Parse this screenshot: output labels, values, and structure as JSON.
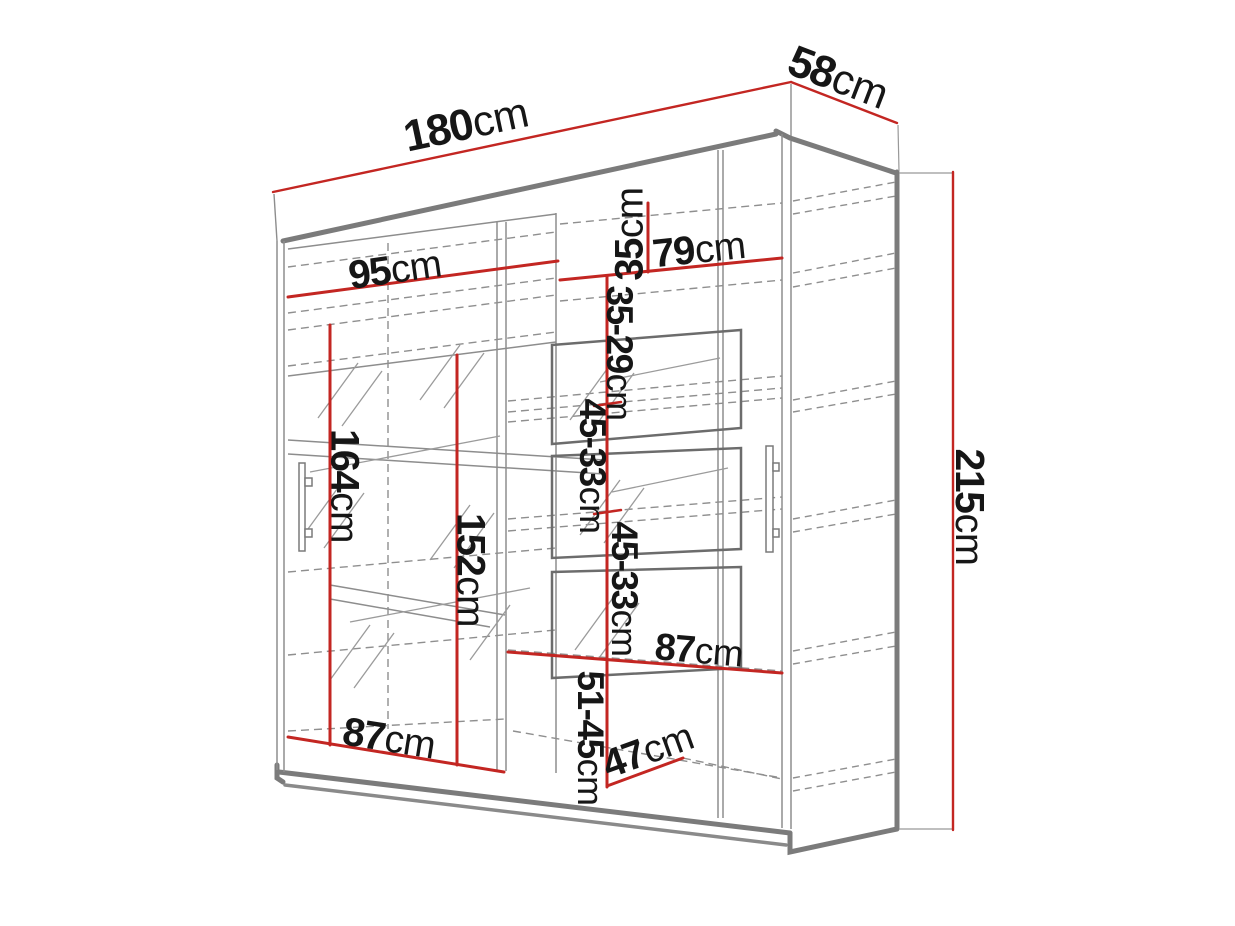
{
  "diagram": {
    "subject": "sliding-door wardrobe technical drawing",
    "colors": {
      "dimension_line": "#c32622",
      "label_text": "#161616",
      "outline_thick": "#7b7b7b",
      "outline_thin": "#8d8d8d",
      "hidden_dashed": "#8f8f8f",
      "background": "#ffffff"
    },
    "dims": {
      "w180": {
        "num": "180",
        "unit": "cm"
      },
      "d58": {
        "num": "58",
        "unit": "cm"
      },
      "w95": {
        "num": "95",
        "unit": "cm"
      },
      "w79": {
        "num": "79",
        "unit": "cm"
      },
      "h35": {
        "num": "35",
        "unit": "cm"
      },
      "h35_29": {
        "num": "35-29",
        "unit": "cm"
      },
      "h45_33a": {
        "num": "45-33",
        "unit": "cm"
      },
      "h45_33b": {
        "num": "45-33",
        "unit": "cm"
      },
      "h164": {
        "num": "164",
        "unit": "cm"
      },
      "h152": {
        "num": "152",
        "unit": "cm"
      },
      "h215": {
        "num": "215",
        "unit": "cm"
      },
      "w87mid": {
        "num": "87",
        "unit": "cm"
      },
      "w87bot": {
        "num": "87",
        "unit": "cm"
      },
      "h51_45": {
        "num": "51-45",
        "unit": "cm"
      },
      "d47": {
        "num": "47",
        "unit": "cm"
      }
    }
  }
}
